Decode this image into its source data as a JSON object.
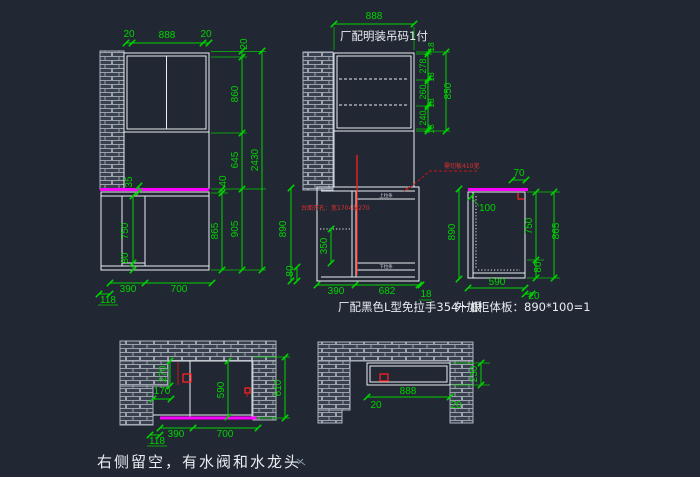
{
  "colors": {
    "background": "#222833",
    "line": "#e9edf2",
    "dimension": "#00d400",
    "counter_top": "#ff00ff",
    "warning": "#ff2020",
    "brick_fill": "#39414e",
    "brick_mortar": "#9aa3ae"
  },
  "captions": {
    "hanger_note": "厂配明装吊码1付",
    "handle_note": "厂配黑色L型免拉手354一根",
    "board_note": "外加柜体板：890*100=1",
    "bottom_note": "右侧留空，有水阀和水龙头",
    "red_cut_note": "需切板410宽",
    "red_sink_note": "台面开孔：宽1704深270",
    "rail_label_top": "上拉条",
    "rail_label_bottom": "下拉条"
  },
  "left_view": {
    "top_dims": [
      "20",
      "888",
      "20"
    ],
    "right_dims": {
      "top": "20",
      "upper": "860",
      "middle": "645",
      "counter": "40",
      "lower": "865",
      "lower_total": "905",
      "total": "2430"
    },
    "inner_dims": {
      "counter_thickness": "35",
      "door_height": "750",
      "toe_kick": "80"
    },
    "bottom_dims": {
      "left": "390",
      "right": "700",
      "offset": "118"
    }
  },
  "middle_view": {
    "top_dim": "888",
    "shelf_dims": [
      "18",
      "278",
      "18",
      "260",
      "18",
      "240",
      "18"
    ],
    "shelf_total": "850",
    "left_dims": {
      "height": "890",
      "toe_kick": "80"
    },
    "inner_dims": {
      "drawer": "350"
    },
    "bottom_dims": {
      "left": "390",
      "right": "682",
      "offset": "18"
    }
  },
  "side_view": {
    "top_dim": "70",
    "inner_dim": "100",
    "left_dim": "890",
    "right_dims": {
      "door": "750",
      "toe_kick": "80",
      "total": "865"
    },
    "bottom_dims": {
      "depth": "590",
      "offset": "20"
    }
  },
  "plan_left": {
    "dims": {
      "step_height": "270",
      "step_width": "170",
      "opening": "590",
      "total": "610",
      "left": "390",
      "right": "700",
      "offset": "118"
    }
  },
  "plan_right": {
    "dims": {
      "width": "888",
      "left_gap": "20",
      "right_gap": "20",
      "height": "230"
    }
  }
}
